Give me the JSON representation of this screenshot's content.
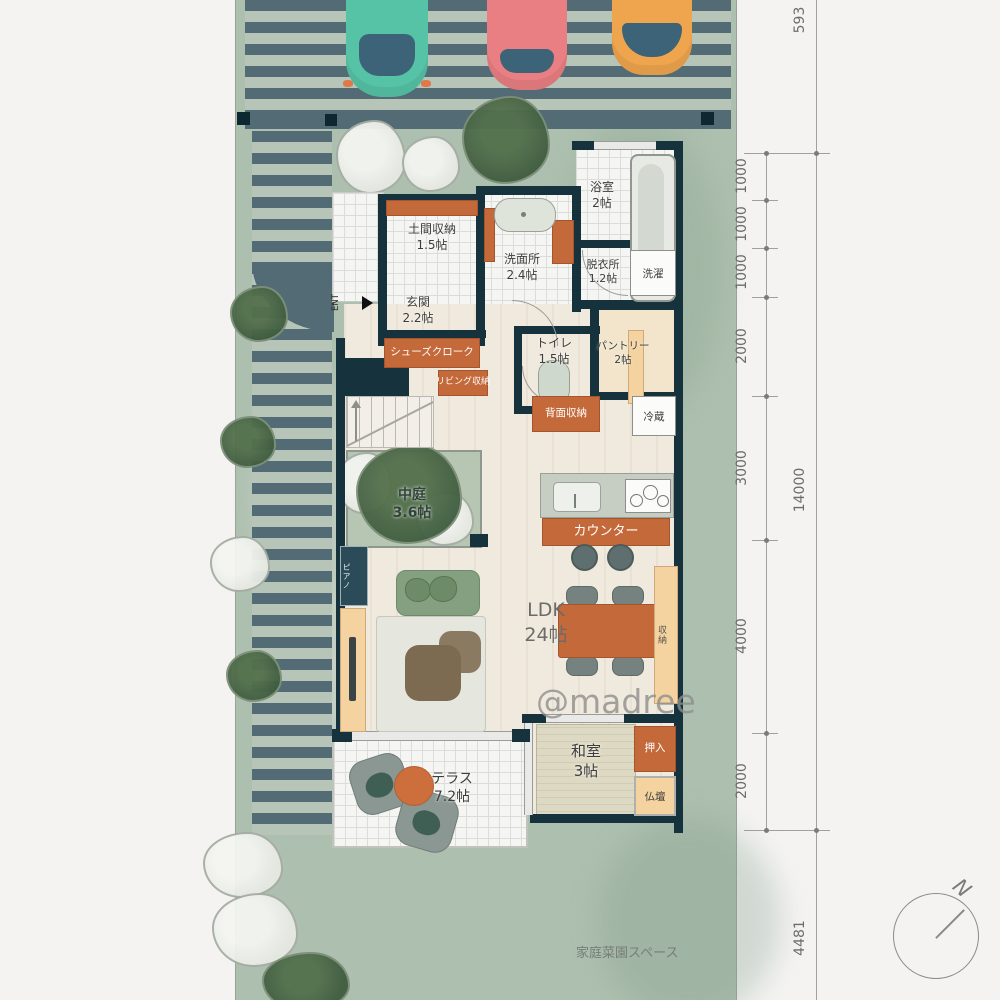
{
  "watermark": "@madree",
  "plan": {
    "rooms": {
      "doma": {
        "label": "土間収納",
        "size": "1.5帖"
      },
      "genkan": {
        "label": "玄関",
        "size": "2.2帖"
      },
      "senmenjo": {
        "label": "洗面所",
        "size": "2.4帖"
      },
      "yokushitsu": {
        "label": "浴室",
        "size": "2帖"
      },
      "datsuijo": {
        "label": "脱衣所",
        "size": "1.2帖"
      },
      "sentaku": {
        "label": "洗濯"
      },
      "toire": {
        "label": "トイレ",
        "size": "1.5帖"
      },
      "pantry": {
        "label": "パントリー",
        "size": "2帖"
      },
      "shoes_cloak": {
        "label": "シューズクローク"
      },
      "living_storage": {
        "label": "リビング収納"
      },
      "back_storage": {
        "label": "背面収納"
      },
      "fridge": {
        "label": "冷蔵"
      },
      "counter": {
        "label": "カウンター"
      },
      "nakaniwa": {
        "label": "中庭",
        "size": "3.6帖"
      },
      "piano": {
        "label": "ピアノ"
      },
      "ldk": {
        "label": "LDK",
        "size": "24帖"
      },
      "bench": {
        "label": "収納"
      },
      "washitsu": {
        "label": "和室",
        "size": "3帖"
      },
      "oshiire": {
        "label": "押入"
      },
      "butsudan": {
        "label": "仏壇"
      },
      "terrace": {
        "label": "テラス",
        "size": "7.2帖"
      },
      "entrance_mark": {
        "label": "ENT"
      },
      "garden": {
        "label": "家庭菜園スペース"
      }
    },
    "dimensions": {
      "outer": [
        "593",
        "14000",
        "4481"
      ],
      "chain": [
        "1000",
        "1000",
        "1000",
        "2000",
        "3000",
        "4000",
        "2000"
      ]
    },
    "compass": {
      "label": "N"
    },
    "colors": {
      "wall": "#16323d",
      "accent_orange": "#c4693a",
      "accent_tan": "#f4d3a0",
      "site_green": "#adbfae",
      "stripe_teal": "#526b74",
      "car_teal": "#56c3a7",
      "car_red": "#e97f82",
      "car_orange": "#efa54e"
    }
  }
}
